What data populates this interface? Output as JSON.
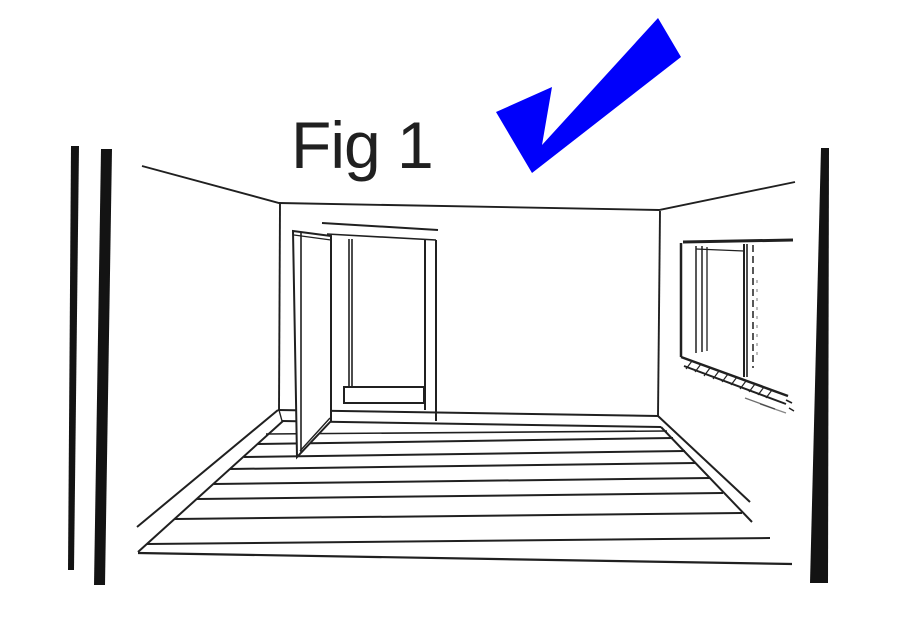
{
  "figure": {
    "label": "Fig 1"
  },
  "annotation": {
    "icon": "blue-checkmark-icon",
    "checkmark_color": "#0000fb"
  },
  "palette": {
    "ink": "#202020",
    "bar": "#131313",
    "background": "#ffffff"
  },
  "drawing_elements": [
    "left-page-edge-bars",
    "ceiling-edge",
    "left-wall-corner",
    "right-wall-corner",
    "back-wall",
    "open-door",
    "door-frame",
    "doorway-step",
    "window",
    "window-sill-hatching",
    "floorboards",
    "baseboards",
    "right-page-edge-bar"
  ]
}
